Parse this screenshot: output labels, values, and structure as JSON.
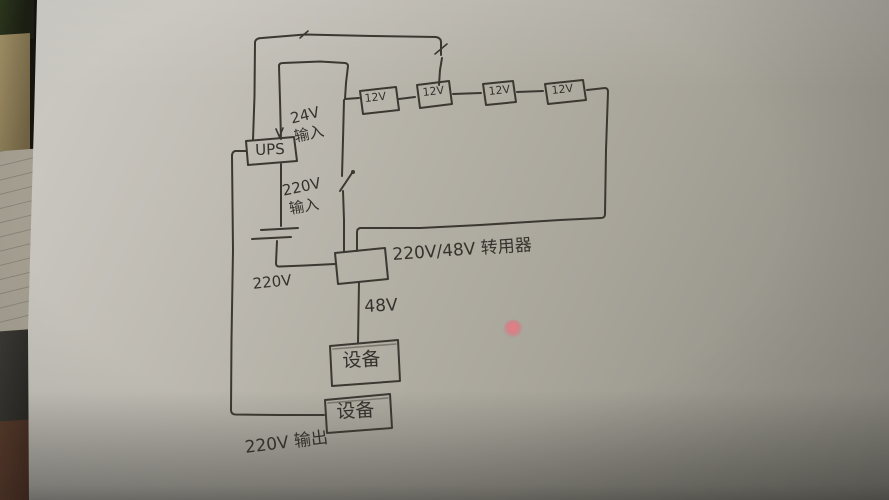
{
  "scene": {
    "description": "photo of a hand-drawn UPS power wiring sketch on paper",
    "paper_color": "#b3b0a6",
    "background_color": "#17140f",
    "ink_color": "#3b3832",
    "laser_dot_color": "#e87880"
  },
  "diagram": {
    "ups": {
      "label": "UPS"
    },
    "batteries": [
      {
        "label": "12V"
      },
      {
        "label": "12V"
      },
      {
        "label": "12V"
      },
      {
        "label": "12V"
      }
    ],
    "converter": {
      "label": "220V/48V 转用器"
    },
    "devices": [
      {
        "label": "设备"
      },
      {
        "label": "设备"
      }
    ],
    "annotations": {
      "battery_input_line1": "24V",
      "battery_input_line2": "输入",
      "mains_input_line1": "220V",
      "mains_input_line2": "输入",
      "wire_220v": "220V",
      "wire_48v": "48V",
      "output_220v": "220V 输出"
    }
  }
}
